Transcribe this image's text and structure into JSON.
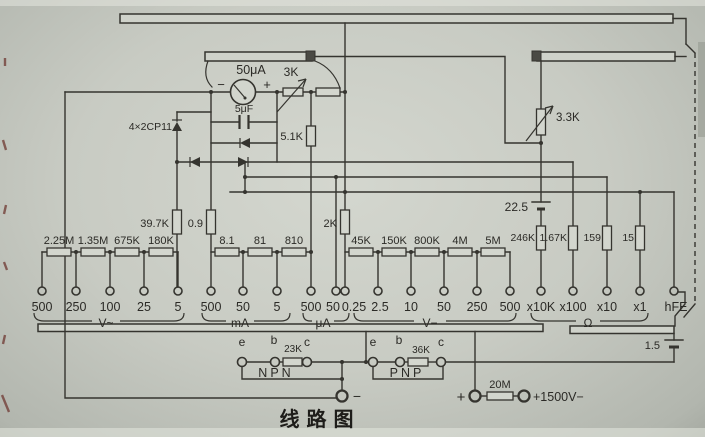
{
  "caption": "线路图",
  "meter": {
    "label": "50μA",
    "minus": "−",
    "plus": "+"
  },
  "top": {
    "pot": "3K",
    "trimmer": "3.3K"
  },
  "bridge": {
    "diodes": "4×2CP11",
    "cap": "5μF",
    "shunt": "5.1K"
  },
  "mid_resistors": {
    "r1": "39.7K",
    "r2": "0.9",
    "r3": "2K"
  },
  "ohm_branch": {
    "battery": "22.5",
    "r1": "246K",
    "r2": "1.67K",
    "r3": "159",
    "r4": "15"
  },
  "sections": {
    "vac": {
      "label": "V~",
      "resistors": [
        "2.25M",
        "1.35M",
        "675K",
        "180K"
      ],
      "taps": [
        "500",
        "250",
        "100",
        "25",
        "5"
      ]
    },
    "ma": {
      "label": "mA",
      "resistors": [
        "8.1",
        "81",
        "810"
      ],
      "taps": [
        "500",
        "50",
        "5"
      ]
    },
    "ua": {
      "label": "μA",
      "taps": [
        "500",
        "50"
      ]
    },
    "vdc": {
      "label": "V−",
      "resistors": [
        "45K",
        "150K",
        "800K",
        "4M",
        "5M"
      ],
      "taps": [
        "0.25",
        "2.5",
        "10",
        "50",
        "250",
        "500"
      ]
    },
    "ohm": {
      "label": "Ω",
      "taps": [
        "x10K",
        "x100",
        "x10",
        "x1"
      ]
    },
    "hfe": {
      "label": "hFE"
    }
  },
  "transistor": {
    "npn": {
      "label": "NPN",
      "e": "e",
      "b": "b",
      "c": "c",
      "resistor": "23K"
    },
    "pnp": {
      "label": "PNP",
      "e": "e",
      "b": "b",
      "c": "c",
      "resistor": "36K"
    }
  },
  "bottom": {
    "battery": "1.5",
    "minus": "−",
    "plus": "+",
    "resistor": "20M",
    "hv_label": "+1500V−"
  }
}
